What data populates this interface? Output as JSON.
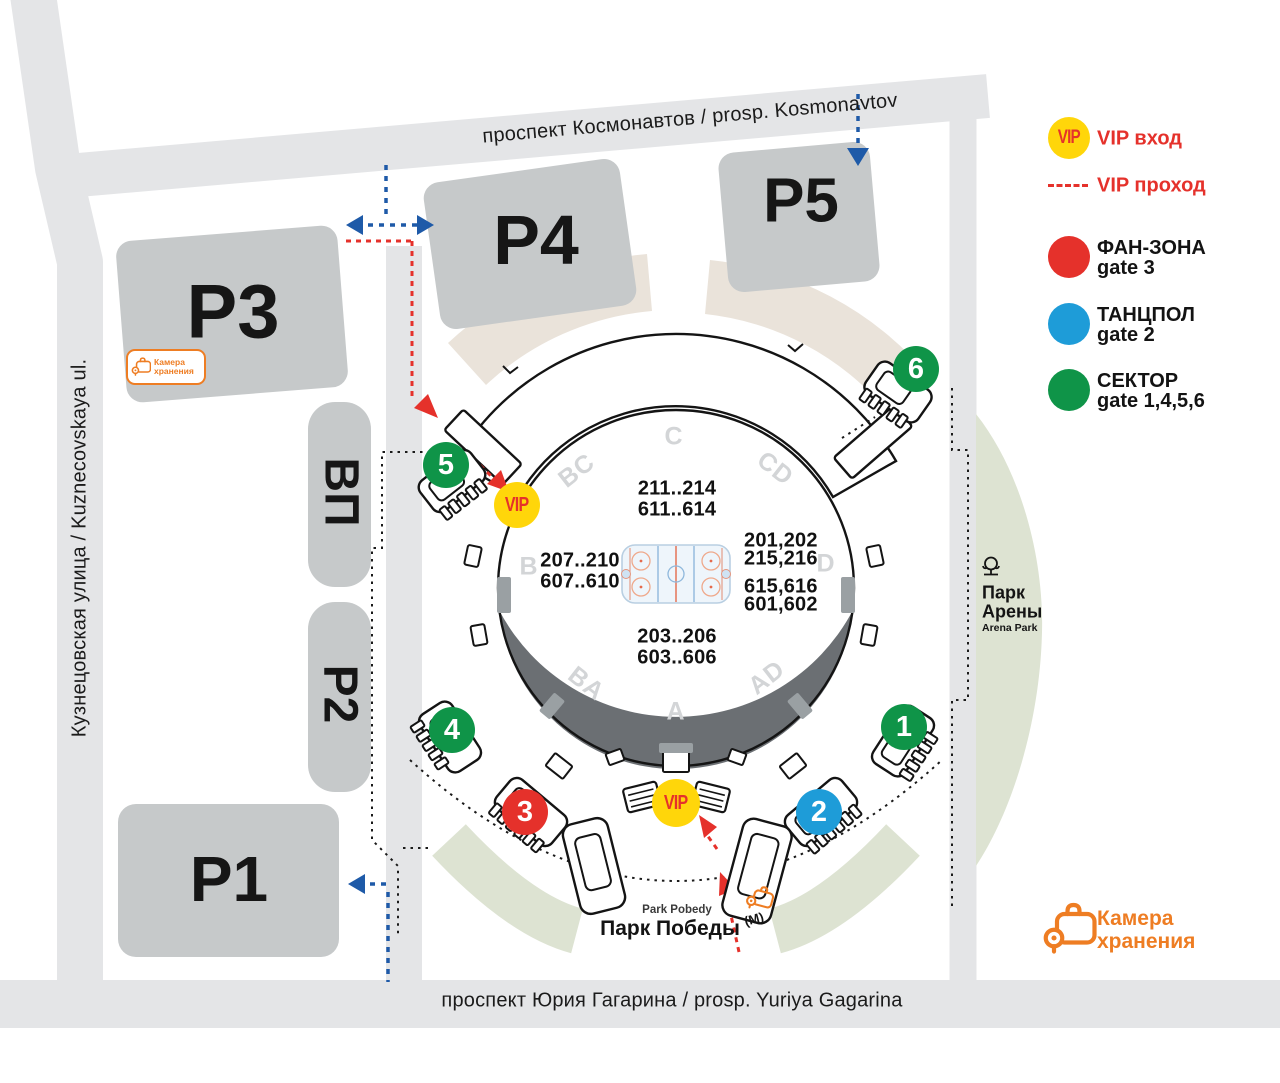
{
  "streets": {
    "top": "проспект Космонавтов / prosp. Kosmonavtov",
    "bottom": "проспект Юрия Гагарина / prosp. Yuriya Gagarina",
    "left": "Кузнецовская улица / Kuznecovskaya ul."
  },
  "parking": {
    "p1": "Р1",
    "p2": "Р2",
    "p3": "Р3",
    "p4": "Р4",
    "p5": "Р5",
    "vp": "ВП"
  },
  "arena": {
    "sections": {
      "c": "C",
      "bc": "BC",
      "cd": "CD",
      "b": "B",
      "d": "D",
      "ba": "BA",
      "ad": "AD",
      "a": "A"
    },
    "seat_ranges": {
      "top": [
        "211..214",
        "611..614"
      ],
      "left": [
        "207..210",
        "607..610"
      ],
      "right": [
        "201,202",
        "215,216",
        "615,616",
        "601,602"
      ],
      "bottom": [
        "203..206",
        "603..606"
      ]
    }
  },
  "gates": {
    "g1": {
      "label": "1",
      "color": "#0f9448"
    },
    "g2": {
      "label": "2",
      "color": "#1e9cd8"
    },
    "g3": {
      "label": "3",
      "color": "#e5312b"
    },
    "g4": {
      "label": "4",
      "color": "#0f9448"
    },
    "g5": {
      "label": "5",
      "color": "#0f9448"
    },
    "g6": {
      "label": "6",
      "color": "#0f9448"
    },
    "vip_left": {
      "label": "VIP"
    },
    "vip_bottom": {
      "label": "VIP"
    }
  },
  "legend": {
    "vip_entrance": {
      "badge": "VIP",
      "label": "VIP вход"
    },
    "vip_pass": {
      "label": "VIP проход"
    },
    "items": [
      {
        "label": "ФАН-ЗОНА",
        "gate": "gate 3",
        "color": "#e5312b"
      },
      {
        "label": "ТАНЦПОЛ",
        "gate": "gate 2",
        "color": "#1e9cd8"
      },
      {
        "label": "СЕКТОР",
        "gate": "gate 1,4,5,6",
        "color": "#0f9448"
      }
    ]
  },
  "park": {
    "name_line1": "Парк",
    "name_line2": "Арены",
    "name_latin": "Arena Park"
  },
  "metro": {
    "name_latin": "Park Pobedy",
    "name": "Парк Победы",
    "mark": "(М)"
  },
  "luggage": {
    "line1": "Камера",
    "line2": "хранения"
  },
  "colors": {
    "accent_red": "#e5312b",
    "accent_blue": "#1e9cd8",
    "accent_green": "#0f9448",
    "vip_yellow": "#ffd60a",
    "orange": "#ee7d23",
    "route_blue": "#1e5aa8",
    "street_gray": "#e4e5e7",
    "block_gray": "#c6c9ca",
    "stand_beige": "#eae3da",
    "park_green": "#dde3d2",
    "stage_dark": "#6b6f73"
  }
}
